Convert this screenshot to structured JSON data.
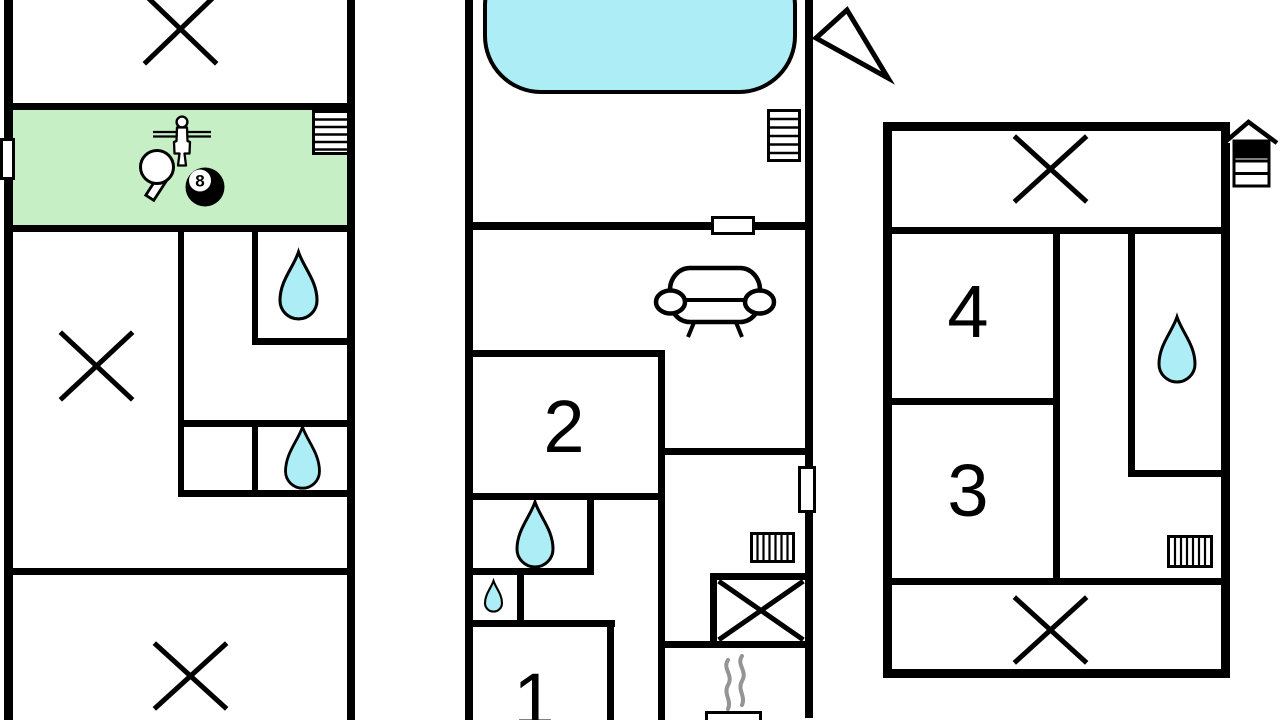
{
  "colors": {
    "wall": "#000000",
    "background": "#ffffff",
    "game-room-fill": "#c7efc5",
    "water-fill": "#adeef6",
    "steam": "#949494"
  },
  "labels": {
    "room_1": "1",
    "room_2": "2",
    "room_3": "3",
    "room_4": "4",
    "eight_ball": "8"
  },
  "icons": {
    "left_plan": [
      "cross-icon",
      "window-icon",
      "stairs-icon",
      "table-tennis-paddle-icon",
      "foosball-player-icon",
      "eight-ball-icon",
      "water-drop-icon",
      "water-drop-icon",
      "cross-icon",
      "cross-icon"
    ],
    "middle_plan": [
      "pool-icon",
      "north-arrow-icon",
      "stairs-icon",
      "window-icon",
      "sofa-icon",
      "water-drop-icon",
      "water-drop-icon",
      "door-icon",
      "radiator-icon",
      "shower-cross-icon",
      "sauna-steam-icon",
      "stove-icon"
    ],
    "right_plan": [
      "house-storey-icon",
      "cross-icon",
      "water-drop-icon",
      "radiator-icon",
      "cross-icon"
    ]
  }
}
